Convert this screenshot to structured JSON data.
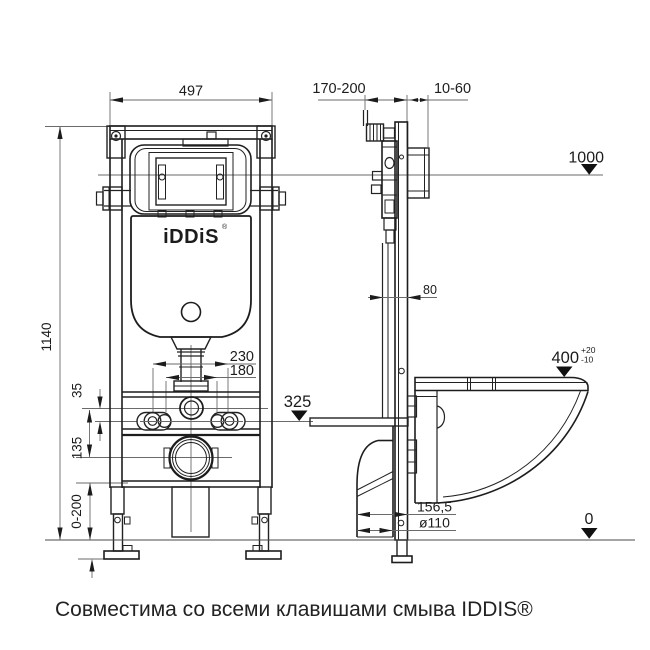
{
  "caption": "Совместима со всеми клавишами смыва IDDIS®",
  "brand": {
    "logo": "iDDiS",
    "mark": "®"
  },
  "front": {
    "width": "497",
    "height": "1140",
    "bolt_outer": "230",
    "bolt_inner": "180",
    "offset_flush": "35",
    "offset_drain": "135",
    "leg_range": "0-200",
    "level_bolts": "325"
  },
  "side": {
    "depth_range": "170-200",
    "bracket_range": "10-60",
    "level_top": "1000",
    "profile_depth": "80",
    "seat_height": "400",
    "tol_plus": "+20",
    "tol_minus": "-10",
    "outlet_offset": "156,5",
    "outlet_diameter": "ø110",
    "level_floor": "0"
  },
  "colors": {
    "line": "#222222",
    "dim": "#6a6a6a",
    "text": "#1c1c1c",
    "bg": "#ffffff"
  }
}
